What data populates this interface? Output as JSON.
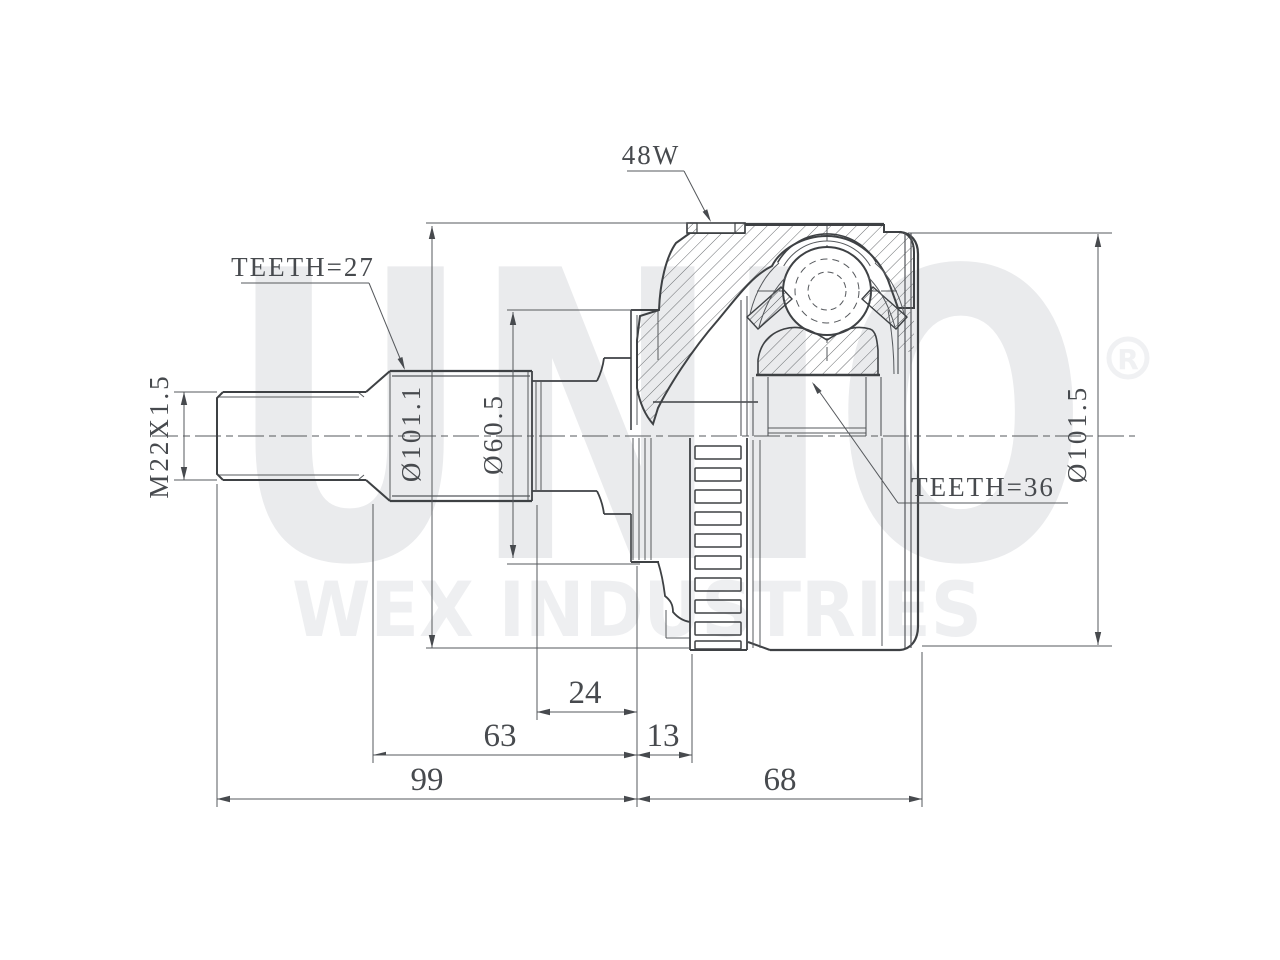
{
  "drawing": {
    "watermark": {
      "brand": "UNIO",
      "subtitle": "WEX INDUSTRIES",
      "registered": "R"
    },
    "labels": {
      "spline_teeth": "TEETH=27",
      "ring_teeth": "TEETH=36",
      "abs_ring": "48W",
      "thread": "M22X1.5",
      "dia_housing": "Ø101.1",
      "dia_shoulder": "Ø60.5",
      "dia_outer": "Ø101.5"
    },
    "dimensions": {
      "d24": "24",
      "d63": "63",
      "d13": "13",
      "d99": "99",
      "d68": "68"
    }
  }
}
